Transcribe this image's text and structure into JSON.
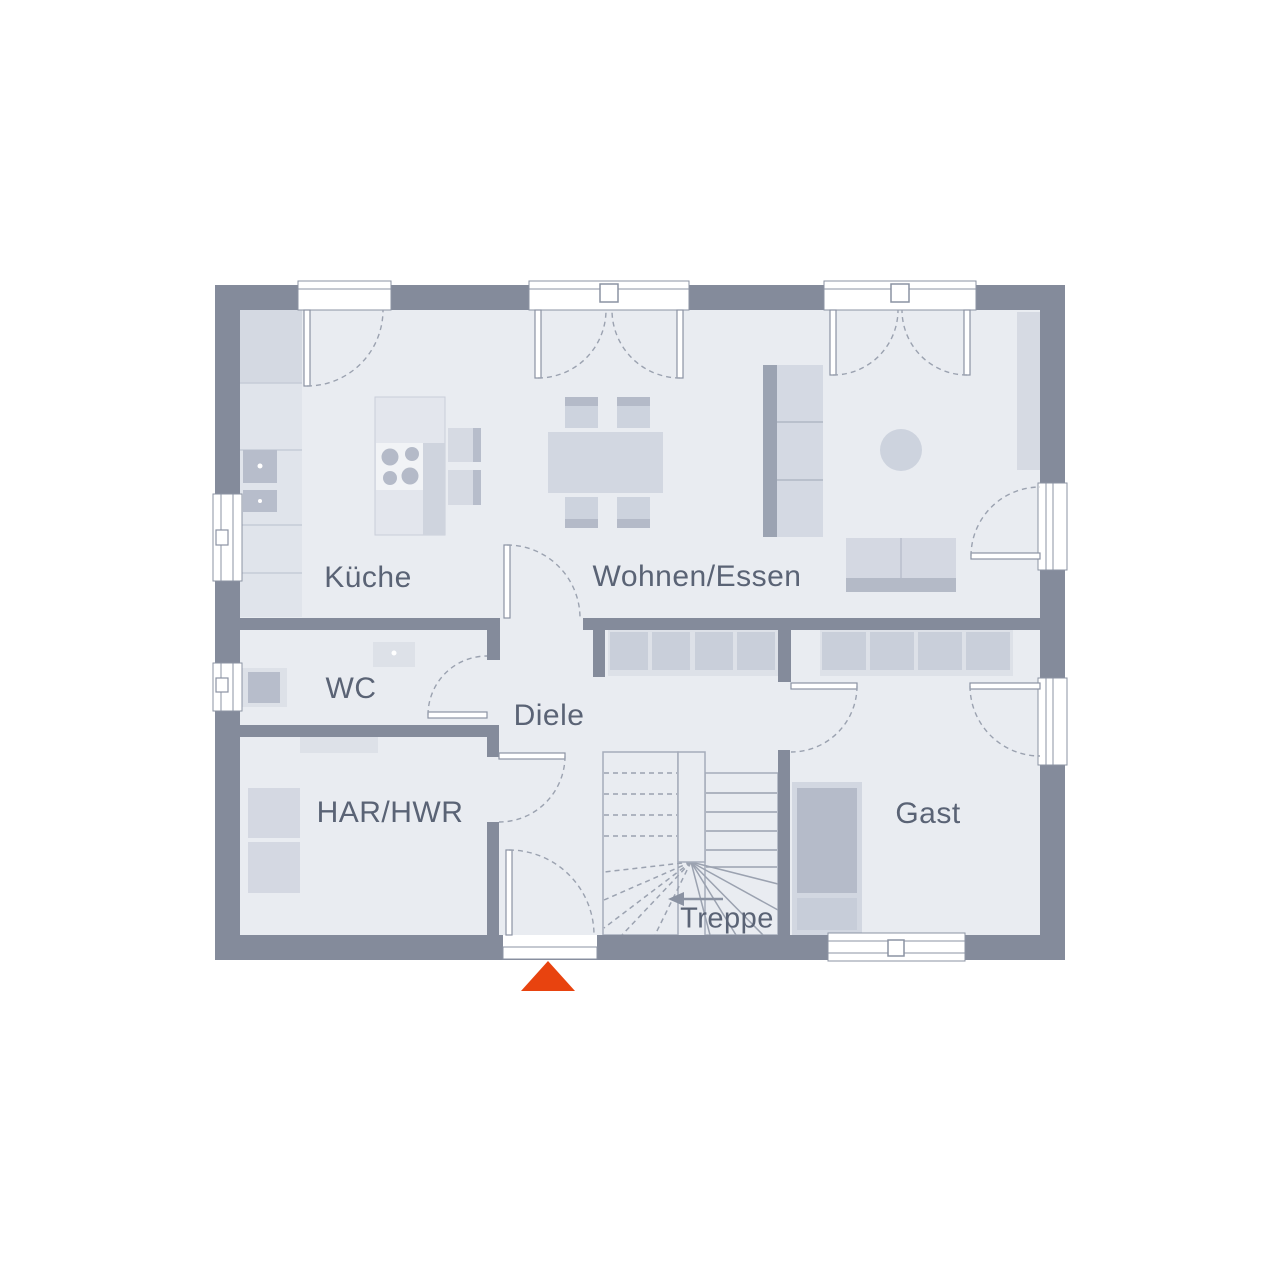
{
  "rooms": {
    "kueche": {
      "label": "Küche"
    },
    "wohnen_essen": {
      "label": "Wohnen/Essen"
    },
    "wc": {
      "label": "WC"
    },
    "diele": {
      "label": "Diele"
    },
    "har_hwr": {
      "label": "HAR/HWR"
    },
    "gast": {
      "label": "Gast"
    },
    "treppe": {
      "label": "Treppe"
    }
  },
  "icons": {
    "entrance_marker": "entrance-direction-triangle",
    "stair_direction": "stair-run-arrow"
  },
  "palette": {
    "wall": "#848b9b",
    "floor": "#e9ecf1",
    "furniture_light": "#dde1e8",
    "furniture_mid": "#cdd3de",
    "furniture_dark": "#b5bbc9",
    "line": "#9ba2b0",
    "label_text": "#5a6375",
    "accent_entrance": "#e8430f"
  }
}
